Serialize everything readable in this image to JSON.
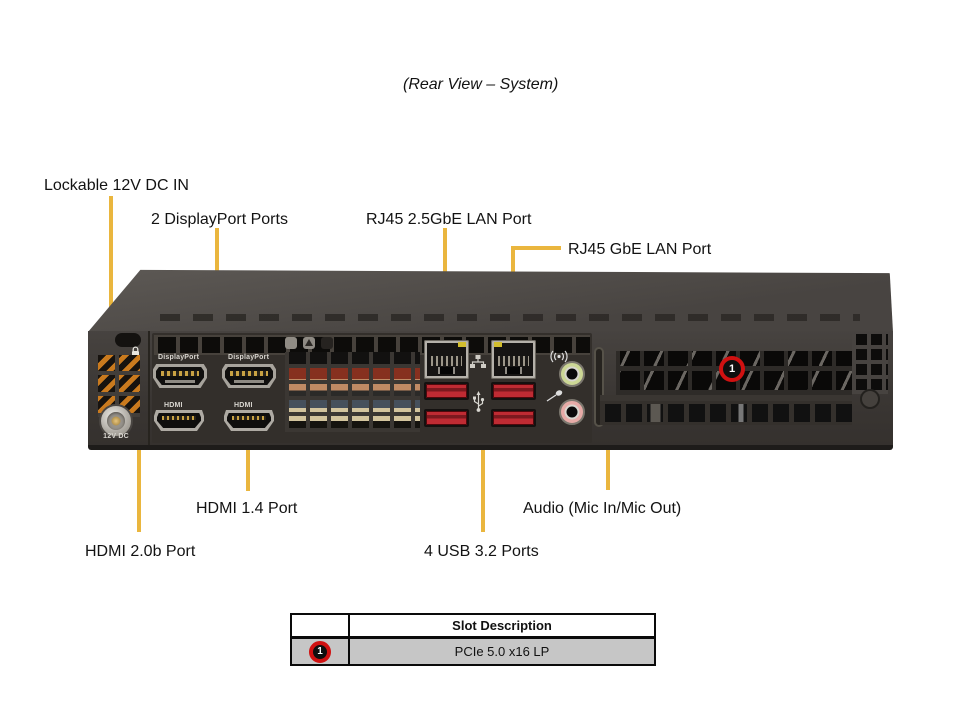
{
  "title": "(Rear View – System)",
  "labels": {
    "dc_in": "Lockable 12V DC IN",
    "displayport": "2 DisplayPort Ports",
    "lan_25gbe": "RJ45 2.5GbE LAN Port",
    "lan_gbe": "RJ45 GbE LAN Port",
    "hdmi14": "HDMI 1.4 Port",
    "audio": "Audio (Mic In/Mic Out)",
    "hdmi20b": "HDMI 2.0b Port",
    "usb": "4 USB 3.2 Ports"
  },
  "chassis": {
    "silkscreen": {
      "dp1": "DisplayPort",
      "dp2": "DisplayPort",
      "hdmi1": "HDMI",
      "hdmi2": "HDMI",
      "dc": "12V DC"
    },
    "slot_marker": "1"
  },
  "table": {
    "header": "Slot Description",
    "rows": [
      {
        "marker": "1",
        "description": "PCIe 5.0 x16 LP"
      }
    ]
  },
  "colors": {
    "callout_line": "#eab63e",
    "usb_port_red": "#bf2b33",
    "marker_red": "#d01111",
    "line_out_green": "#ccd795",
    "mic_pink": "#e7aba7"
  }
}
